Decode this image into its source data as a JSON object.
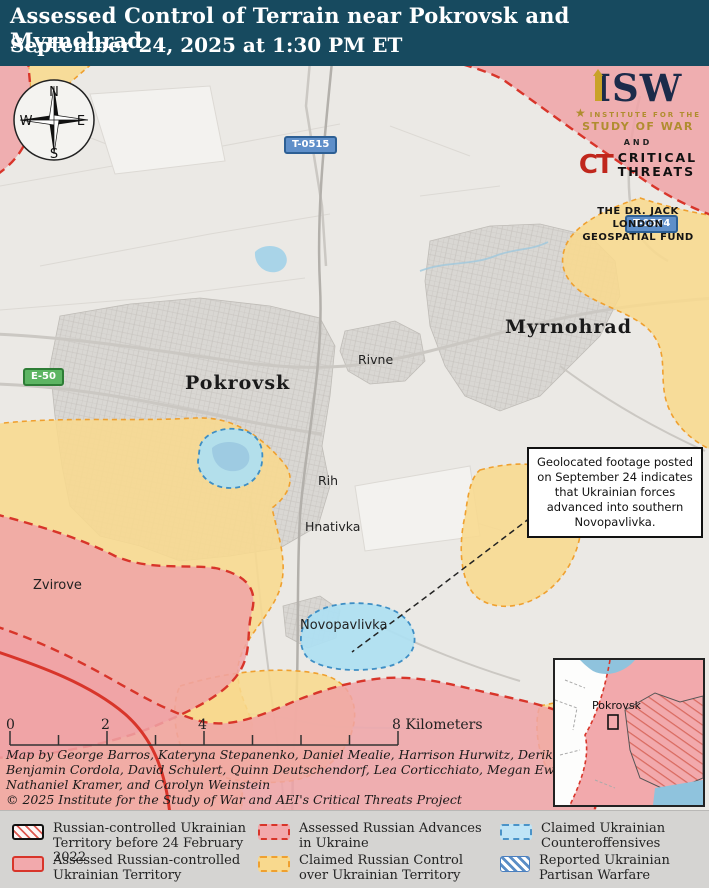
{
  "header": {
    "title": "Assessed Control of Terrain near Pokrovsk and Myrnohrad",
    "subtitle": "September 24, 2025 at 1:30 PM ET"
  },
  "compass": {
    "north": "N",
    "east": "E",
    "south": "S",
    "west": "W"
  },
  "branding": {
    "isw": "ISW",
    "institute_line1": "INSTITUTE FOR THE",
    "institute_line2": "STUDY OF WAR",
    "star": "★",
    "and": "AND",
    "ct": "CT",
    "critical": "CRITICAL",
    "threats": "THREATS",
    "fund_line1": "THE DR. JACK LONDON",
    "fund_line2": "GEOSPATIAL FUND"
  },
  "map": {
    "city_labels": [
      {
        "name": "Pokrovsk"
      },
      {
        "name": "Myrnohrad"
      },
      {
        "name": "Rivne"
      },
      {
        "name": "Rih"
      },
      {
        "name": "Hnativka"
      },
      {
        "name": "Novopavlivka"
      },
      {
        "name": "Zvirove"
      }
    ],
    "road_shields": [
      {
        "label": "T-0515",
        "style": "blue"
      },
      {
        "label": "T-0504",
        "style": "blue"
      },
      {
        "label": "E-50",
        "style": "green"
      }
    ],
    "annotation": "Geolocated footage posted on September 24 indicates that Ukrainian forces advanced into southern Novopavlivka.",
    "scale_bar": {
      "tick_labels": [
        "0",
        "2",
        "4"
      ],
      "end_label": "8 Kilometers"
    },
    "inset": {
      "marker_label": "Pokrovsk"
    }
  },
  "credits": {
    "lines": [
      "Map by George Barros, Kateryna Stepanenko, Daniel Mealie, Harrison Hurwitz, Derik Durbin,",
      "Benjamin Cordola, David Schulert, Quinn Deutschendorf, Lea Corticchiato, Megan Ewert,",
      "Nathaniel Kramer, and Carolyn Weinstein",
      "© 2025 Institute for the Study of War and AEI's Critical Threats Project"
    ]
  },
  "legend": {
    "items": [
      {
        "label": "Russian-controlled Ukrainian Territory before 24 February 2022"
      },
      {
        "label": "Assessed Russian-controlled Ukrainian Territory"
      },
      {
        "label": "Assessed Russian Advances in Ukraine"
      },
      {
        "label": "Claimed Russian Control over Ukrainian Territory"
      },
      {
        "label": "Claimed Ukrainian Counteroffensives"
      },
      {
        "label": "Reported Ukrainian Partisan Warfare"
      }
    ]
  },
  "colors": {
    "header_bg": "#174a5f",
    "russian_controlled_fill": "#f2a9ac",
    "russian_border_red": "#d8352a",
    "claimed_russian_fill": "#f8d98e",
    "claimed_russian_border": "#efa02f",
    "counteroffensive_fill": "#bfe4f6",
    "counteroffensive_border": "#4a93c8",
    "partisan_blue": "#4a7fbf"
  }
}
